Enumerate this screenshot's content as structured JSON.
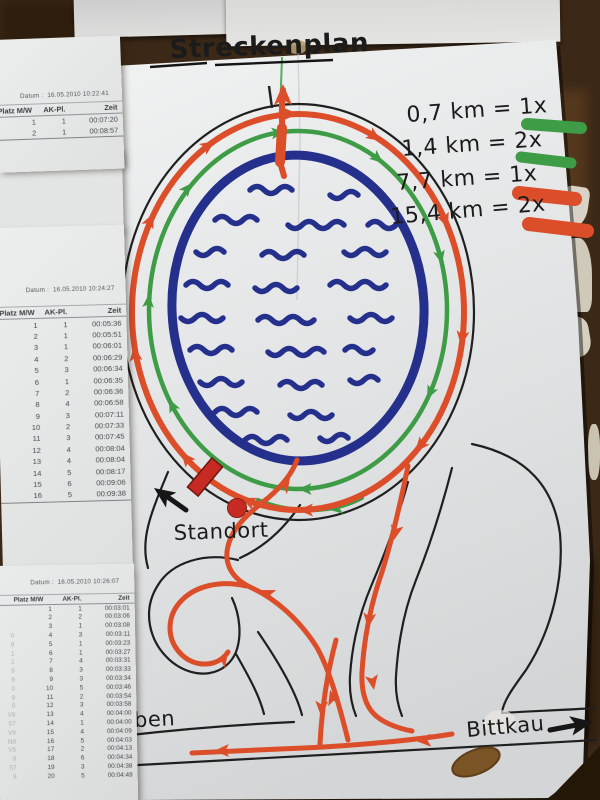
{
  "map": {
    "title": "Streckenplan",
    "legend": [
      {
        "text": "0,7 km = 1x",
        "color": "#3d9c45"
      },
      {
        "text": "1,4 km = 2x",
        "color": "#3d9c45"
      },
      {
        "text": "7,7 km = 1x",
        "color": "#dc4e2a"
      },
      {
        "text": "15,4 km = 2x",
        "color": "#dc4e2a"
      }
    ],
    "labels": {
      "standort": "Standort",
      "start_fragment_line1": "t /",
      "start_fragment_line2": "el",
      "left_town_fragment": "eben",
      "right_town": "Bittkau"
    },
    "colors": {
      "lake": "#25308c",
      "short_route": "#3d9c45",
      "long_route": "#dc4e2a",
      "start_marker": "#c62a22"
    }
  },
  "sheets": [
    {
      "datum_label": "Datum :",
      "datum": "16.05.2010 10:22:41",
      "columns": [
        "Platz M/W",
        "AK-Pl.",
        "Zeit"
      ],
      "rows": [
        [
          "1",
          "1",
          "00:07:20"
        ],
        [
          "2",
          "1",
          "00:08:57"
        ]
      ]
    },
    {
      "datum_label": "Datum :",
      "datum": "16.05.2010 10:24:27",
      "columns": [
        "Platz M/W",
        "AK-Pl.",
        "Zeit"
      ],
      "rows": [
        [
          "1",
          "1",
          "00:05:36"
        ],
        [
          "2",
          "1",
          "00:05:51"
        ],
        [
          "3",
          "1",
          "00:06:01"
        ],
        [
          "4",
          "2",
          "00:06:29"
        ],
        [
          "5",
          "3",
          "00:06:34"
        ],
        [
          "6",
          "1",
          "00:06:35"
        ],
        [
          "7",
          "2",
          "00:06:36"
        ],
        [
          "8",
          "4",
          "00:06:58"
        ],
        [
          "9",
          "3",
          "00:07:11"
        ],
        [
          "10",
          "2",
          "00:07:33"
        ],
        [
          "11",
          "3",
          "00:07:45"
        ],
        [
          "12",
          "4",
          "00:08:04"
        ],
        [
          "13",
          "4",
          "00:08:04"
        ],
        [
          "14",
          "5",
          "00:08:17"
        ],
        [
          "15",
          "6",
          "00:09:06"
        ],
        [
          "16",
          "5",
          "00:09:38"
        ]
      ]
    },
    {
      "datum_label": "Datum :",
      "datum": "16.05.2010 10:26:07",
      "columns": [
        "Platz M/W",
        "AK-Pl.",
        "Zeit"
      ],
      "rows": [
        [
          "",
          "1",
          "1",
          "00:03:01"
        ],
        [
          "",
          "2",
          "2",
          "00:03:06"
        ],
        [
          "",
          "3",
          "1",
          "00:03:08"
        ],
        [
          "0",
          "4",
          "3",
          "00:03:11"
        ],
        [
          "9",
          "5",
          "1",
          "00:03:23"
        ],
        [
          "1",
          "6",
          "1",
          "00:03:27"
        ],
        [
          "1",
          "7",
          "4",
          "00:03:31"
        ],
        [
          "8",
          "8",
          "3",
          "00:03:33"
        ],
        [
          "9",
          "9",
          "3",
          "00:03:34"
        ],
        [
          "0",
          "10",
          "5",
          "00:03:46"
        ],
        [
          "9",
          "11",
          "2",
          "00:03:54"
        ],
        [
          "9",
          "12",
          "3",
          "00:03:58"
        ],
        [
          "V8",
          "13",
          "4",
          "00:04:00"
        ],
        [
          "57",
          "14",
          "1",
          "00:04:00"
        ],
        [
          "V9",
          "15",
          "4",
          "00:04:09"
        ],
        [
          "N9",
          "16",
          "5",
          "00:04:03"
        ],
        [
          "V5",
          "17",
          "2",
          "00:04:13"
        ],
        [
          "8",
          "18",
          "6",
          "00:04:34"
        ],
        [
          "57",
          "19",
          "3",
          "00:04:38"
        ],
        [
          "9",
          "20",
          "5",
          "00:04:49"
        ]
      ]
    }
  ]
}
